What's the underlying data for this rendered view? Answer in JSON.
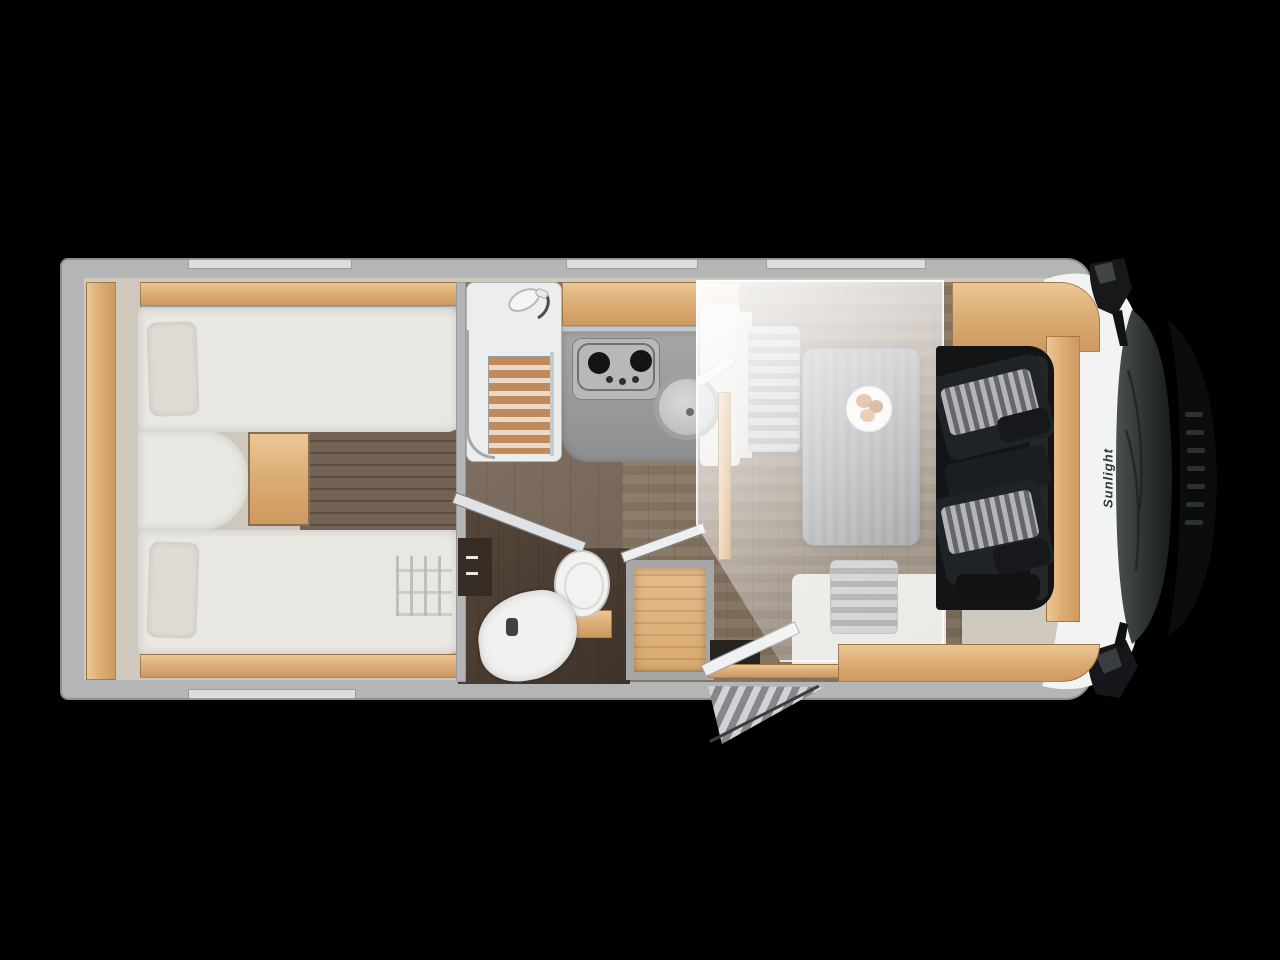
{
  "scene": {
    "type": "motorhome-floorplan-top-view",
    "brand_logo": "Sunlight"
  },
  "features": {
    "rooms": [
      "rear-twin-beds",
      "shower",
      "kitchen",
      "bathroom",
      "wardrobe",
      "dinette",
      "drop-down-bed",
      "cab"
    ],
    "beds": 2,
    "cab_seats": 2,
    "hob_burners_visible": 2,
    "windows_top": 3,
    "windows_bottom": 1,
    "dinette_plate_items": 3
  },
  "palette": {
    "background": "#000000",
    "body_wall": "#b3b5b7",
    "window": "#dcdddd",
    "wood": "#dcae77",
    "floor": "#7d7064",
    "upholstery": "#e9e7e1",
    "pillow": "#dfdcd4",
    "counter": "#9a9c9e",
    "seat_stripe": "#c6c8ca",
    "cab_white": "#f2f3f3",
    "windshield": "#333a36",
    "accent_food": "#c07a40"
  }
}
